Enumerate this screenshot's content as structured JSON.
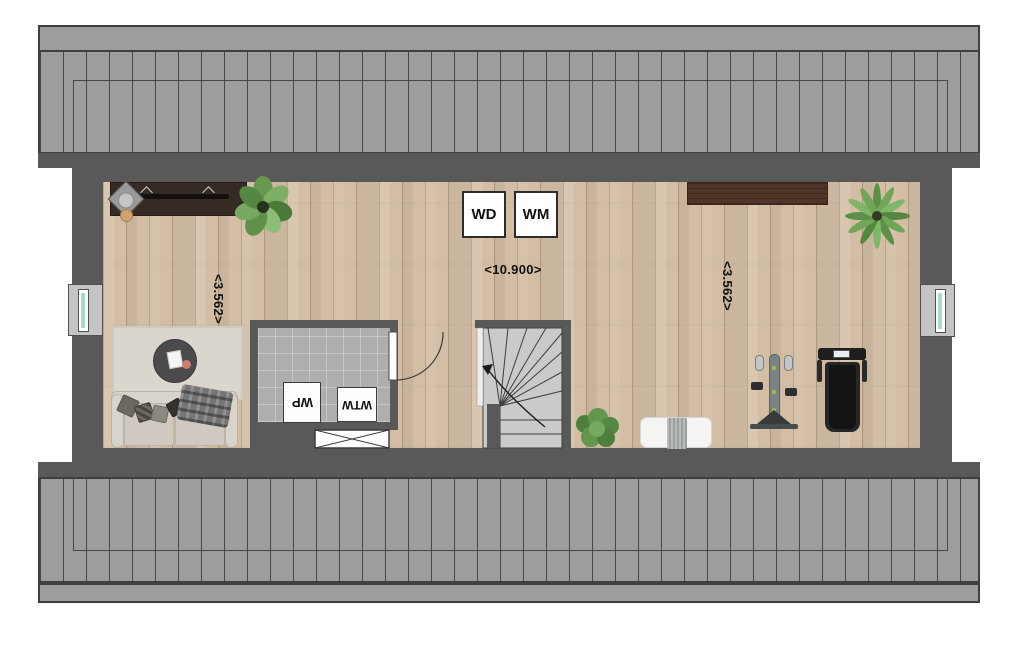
{
  "plan": {
    "appliances": {
      "wd": "WD",
      "wm": "WM"
    },
    "equipment": {
      "wp": "WP",
      "wtw": "WTW"
    },
    "dimensions": {
      "horizontal": "<10.900>",
      "vertical_left": "<3.562>",
      "vertical_right": "<3.562>"
    },
    "colors": {
      "wall": "#595959",
      "roof_fill": "#9d9d9d",
      "roof_line": "#3f3f3f",
      "floor_wood": "#d3bea5",
      "tile_floor": "#aeaeae",
      "stairs": "#cacaca",
      "window_glass": "#a8d8d2",
      "shelf_wood": "#513528"
    },
    "icons": [
      "desk-with-office-chair-icon",
      "fiddle-leaf-plant-icon",
      "washer-dryer-box",
      "washing-machine-box",
      "wall-shelf-icon",
      "palm-plant-icon",
      "area-rug-icon",
      "round-coffee-table-icon",
      "sofa-icon",
      "technical-room",
      "heat-pump-box",
      "heat-recovery-box",
      "void-hatch-icon",
      "interior-door-icon",
      "winder-staircase-icon",
      "stair-direction-arrow-icon",
      "bush-plant-icon",
      "bench-with-towel-icon",
      "exercise-machine-icon",
      "treadmill-icon",
      "window-icon"
    ]
  }
}
